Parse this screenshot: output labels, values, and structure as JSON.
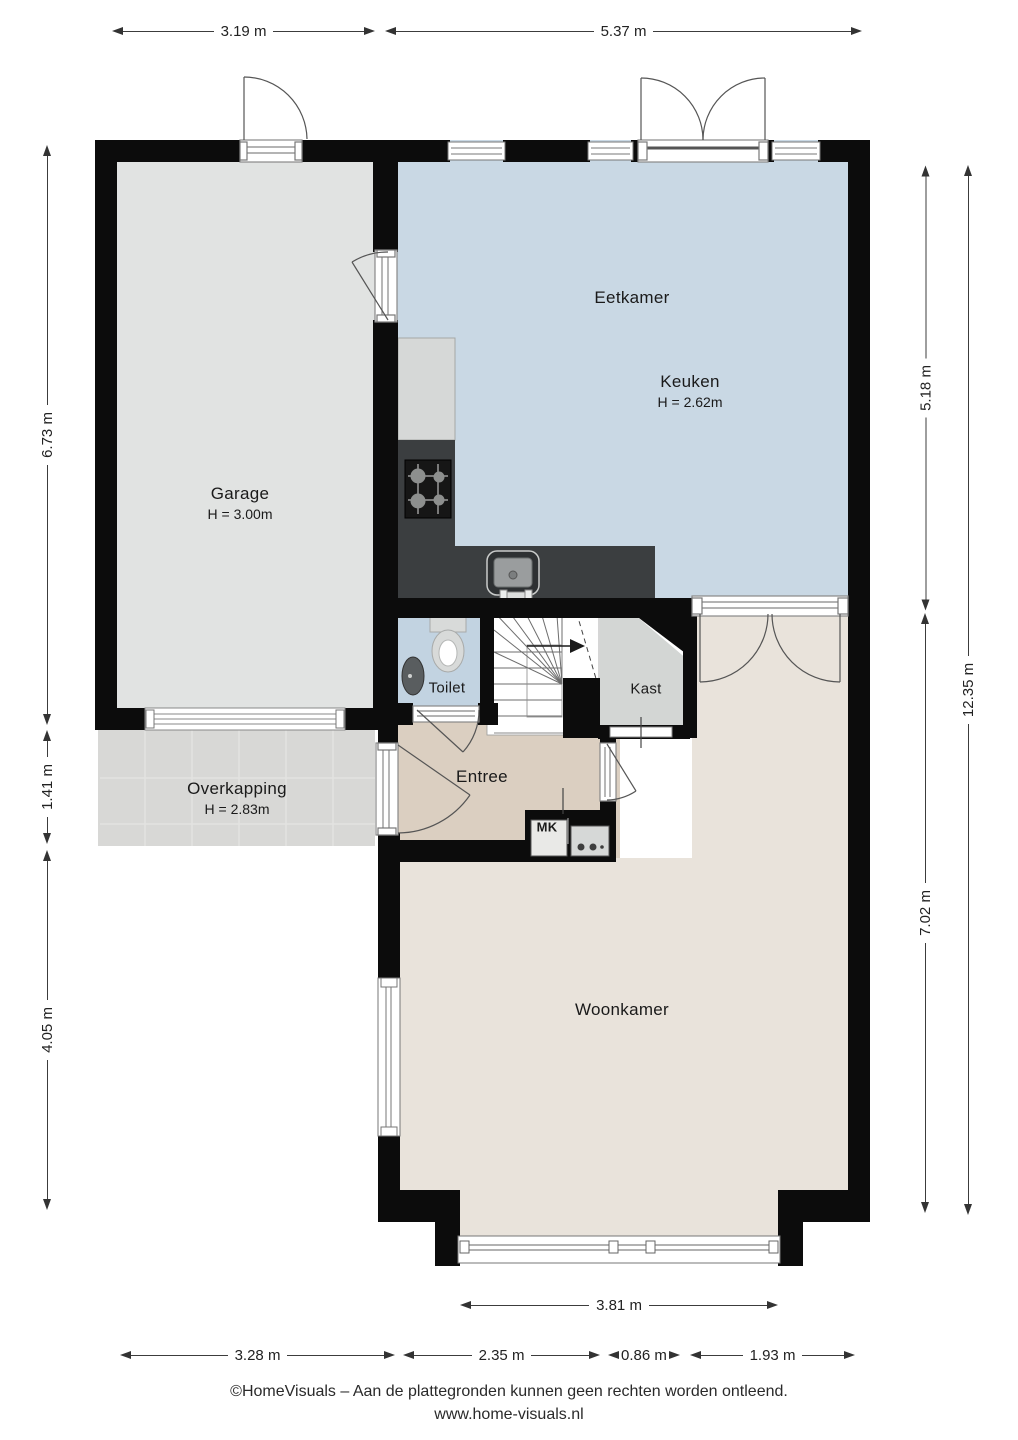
{
  "plan": {
    "rooms": {
      "garage": {
        "name": "Garage",
        "height": "H = 3.00m"
      },
      "eetkamer": {
        "name": "Eetkamer"
      },
      "keuken": {
        "name": "Keuken",
        "height": "H = 2.62m"
      },
      "toilet": {
        "name": "Toilet"
      },
      "kast": {
        "name": "Kast"
      },
      "entree": {
        "name": "Entree"
      },
      "mk": {
        "name": "MK"
      },
      "woonkamer": {
        "name": "Woonkamer"
      },
      "overkapping": {
        "name": "Overkapping",
        "height": "H = 2.83m"
      }
    },
    "dimensions": {
      "top": [
        {
          "label": "3.19 m"
        },
        {
          "label": "5.37 m"
        }
      ],
      "left": [
        {
          "label": "6.73 m"
        },
        {
          "label": "1.41 m"
        },
        {
          "label": "4.05 m"
        }
      ],
      "right": [
        {
          "label": "5.18 m"
        },
        {
          "label": "12.35 m"
        },
        {
          "label": "7.02 m"
        }
      ],
      "bottom_window": {
        "label": "3.81 m"
      },
      "bottom": [
        {
          "label": "3.28 m"
        },
        {
          "label": "2.35 m"
        },
        {
          "label": "0.86 m"
        },
        {
          "label": "1.93 m"
        }
      ]
    },
    "footer": {
      "line1": "©HomeVisuals – Aan de plattegronden kunnen geen rechten worden ontleend.",
      "line2": "www.home-visuals.nl"
    },
    "colors": {
      "wall": "#0c0c0c",
      "garage_floor": "#e1e3e2",
      "kitchen_floor": "#c9d8e4",
      "toilet_floor": "#c2d3e1",
      "kast_floor": "#d3d6d4",
      "entree_floor": "#dbcfc1",
      "woonkamer_floor": "#e9e3db",
      "overkapping_floor": "#d8d8d6",
      "counter_dark": "#3b3e40"
    }
  }
}
